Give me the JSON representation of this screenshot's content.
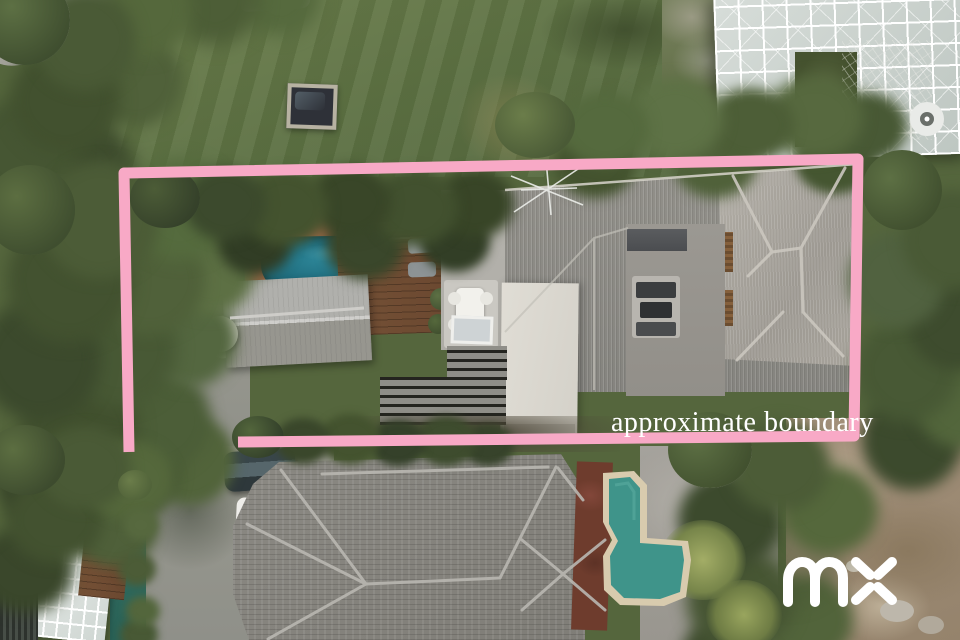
{
  "scene": {
    "description": "Aerial drone photo of a residential property",
    "regions": {
      "upper_garden": "lawn with covered spa and greenhouse",
      "property": "house with pool, decks and grey roofs",
      "neighbor": "tiled roof house with angular pool"
    }
  },
  "overlay": {
    "boundary_label": "approximate boundary",
    "boundary_color": "#f8a9c6",
    "label_color": "#ffffff",
    "watermark_logo": "mx",
    "watermark_color": "#ffffff"
  }
}
